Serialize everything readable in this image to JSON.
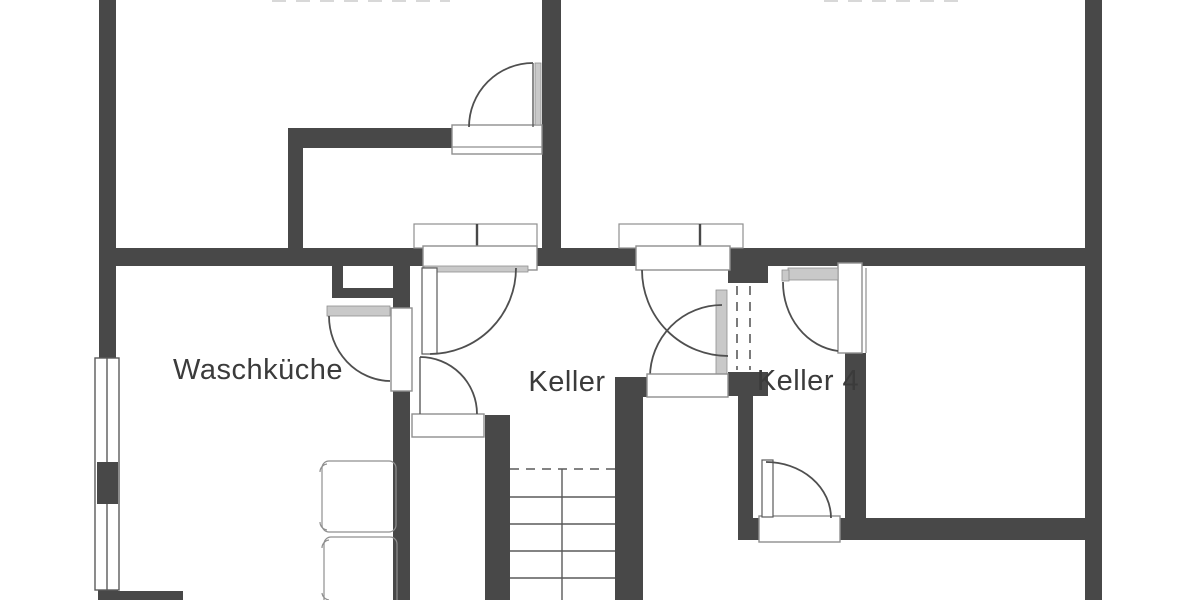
{
  "plan": {
    "rooms": [
      {
        "id": "waschkueche",
        "label": "Waschküche"
      },
      {
        "id": "keller",
        "label": "Keller"
      },
      {
        "id": "keller4",
        "label": "Keller 4"
      }
    ],
    "colors": {
      "wall": "#484848",
      "line": "#5a5a5a",
      "arc": "#4f4f4f",
      "frame": "#8f8f8f",
      "accent": "#c9c9c9",
      "text": "#3b3b3b",
      "bg": "#ffffff",
      "faint": "#d8d8d8"
    }
  }
}
